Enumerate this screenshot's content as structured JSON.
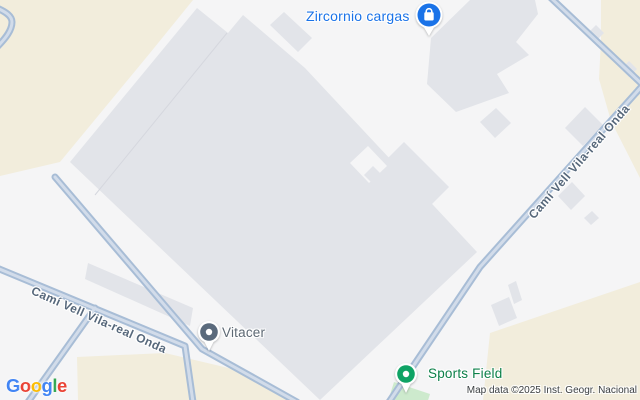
{
  "window": {
    "width": 640,
    "height": 400
  },
  "map": {
    "type": "google-map-roadmap",
    "road_label": "Camí Vell Vila-real Onda",
    "attribution": "Map data ©2025 Inst. Geogr. Nacional",
    "pois": [
      {
        "name": "Zircornio cargas",
        "category": "shopping",
        "label_color": "#1a73e8",
        "pin_color": "#1a73e8",
        "pin_glyph": "shopping-bag"
      },
      {
        "name": "Vitacer",
        "category": "generic-place",
        "label_color": "#5e6974",
        "pin_color": "#5a6a7c",
        "pin_glyph": "dot"
      },
      {
        "name": "Sports Field",
        "category": "sports",
        "label_color": "#0c8049",
        "pin_color": "#0fa365",
        "pin_glyph": "dot"
      }
    ],
    "logo": {
      "text": "Google",
      "letters": [
        [
          "G",
          "#4285F4"
        ],
        [
          "o",
          "#EA4335"
        ],
        [
          "o",
          "#FBBC04"
        ],
        [
          "g",
          "#4285F4"
        ],
        [
          "l",
          "#34A853"
        ],
        [
          "e",
          "#EA4335"
        ]
      ]
    },
    "palette": {
      "land": "#f5f5f6",
      "building": "#e2e4e9",
      "scrubland": "#f2eddc",
      "road_casing": "#a8bdd6",
      "road_core": "#d2dcea",
      "sports_green": "#cdeacd",
      "road_label_color": "#57687b"
    }
  }
}
